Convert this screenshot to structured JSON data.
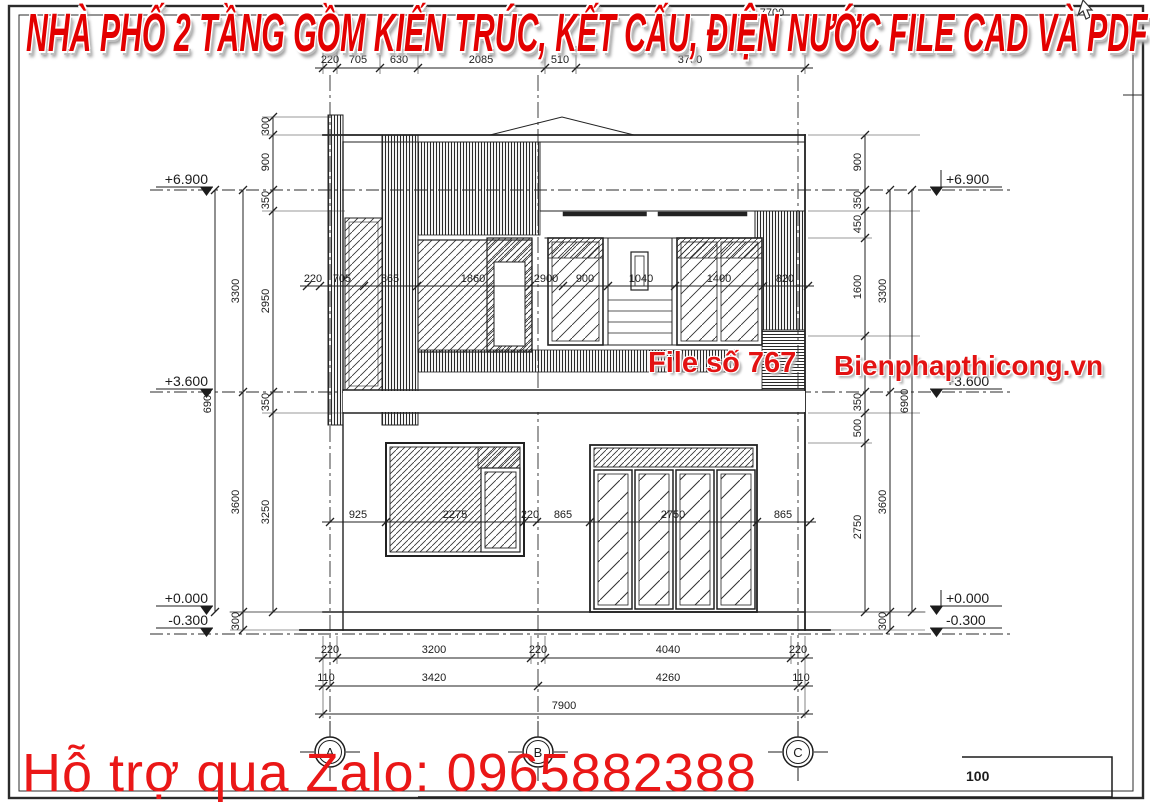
{
  "banner": {
    "title": "NHÀ PHỐ 2 TẦNG GỒM KIẾN TRÚC, KẾT CẤU, ĐIỆN NƯỚC FILE CAD VÀ PDF"
  },
  "watermark": {
    "file_no": "File số 767",
    "website": "Bienphapthicong.vn",
    "support": "Hỗ trợ qua Zalo: 0965882388"
  },
  "colors": {
    "accent_red": "#e30000",
    "line": "#222222",
    "paper": "#ffffff"
  },
  "levels": {
    "p6900": "+6.900",
    "p3600": "+3.600",
    "p0000": "+0.000",
    "m0300": "-0.300"
  },
  "grid_labels": [
    "A",
    "B",
    "C"
  ],
  "scale_label": "100",
  "partial_dim": "7700",
  "dims": {
    "top": [
      "220",
      "705",
      "630",
      "2085",
      "510",
      "3750"
    ],
    "upper_mid": [
      "220",
      "705",
      "865",
      "1860",
      "2900",
      "900",
      "1040",
      "1400",
      "820"
    ],
    "lower_mid": [
      "925",
      "2275",
      "220",
      "865",
      "2750",
      "865"
    ],
    "bottom1": [
      "220",
      "3200",
      "220",
      "4040",
      "220"
    ],
    "bottom2": [
      "110",
      "3420",
      "4260",
      "110"
    ],
    "bottom3": [
      "7900"
    ],
    "left_inner": [
      "300",
      "900",
      "350",
      "2950",
      "350",
      "3250"
    ],
    "left_mid": [
      "3300",
      "3600",
      "300"
    ],
    "left_outer": [
      "6900"
    ],
    "right_inner": [
      "900",
      "350",
      "450",
      "1600",
      "350",
      "500",
      "2750"
    ],
    "right_mid": [
      "3300",
      "3600",
      "300"
    ],
    "right_outer": [
      "6900"
    ]
  }
}
